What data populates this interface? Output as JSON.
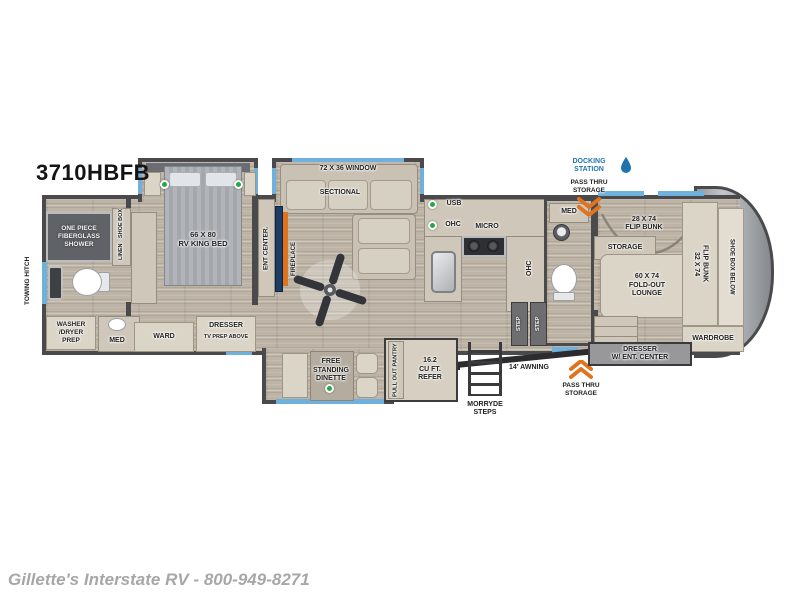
{
  "header": {
    "model": "3710HBFB"
  },
  "footer": {
    "dealer": "Gillette's Interstate RV - 800-949-8271"
  },
  "exterior": {
    "towing_hitch": "TOWING HITCH",
    "docking_station": "DOCKING\nSTATION",
    "pass_thru_top": "PASS THRU\nSTORAGE",
    "pass_thru_bottom": "PASS THRU\nSTORAGE",
    "awning": "14' AWNING",
    "steps": "MORRYDE\nSTEPS"
  },
  "front_bath": {
    "shower": "ONE PIECE\nFIBERGLASS\nSHOWER",
    "shoe_box": "SHOE BOX",
    "linen": "LINEN",
    "washer_dryer": "WASHER\n/DRYER\nPREP",
    "med": "MED"
  },
  "bedroom": {
    "king_bed": "66 X 80\nRV KING BED",
    "ward": "WARD",
    "dresser": "DRESSER",
    "tv_prep": "TV PREP ABOVE",
    "ent_center": "ENT CENTER.",
    "fireplace": "FIREPLACE"
  },
  "living": {
    "window": "72 X 36 WINDOW",
    "sectional": "SECTIONAL",
    "usb": "USB",
    "dinette": "FREE\nSTANDING\nDINETTE"
  },
  "kitchen": {
    "ohc": "OHC",
    "micro": "MICRO",
    "ohc_island": "OHC",
    "pantry": "PULL OUT PANTRY",
    "refer": "16.2\nCU FT.\nREFER"
  },
  "half_bath": {
    "med": "MED",
    "step_a": "STEP",
    "step_b": "STEP"
  },
  "bunk_room": {
    "flip_bunk_a": "28 X 74\nFLIP BUNK",
    "storage": "STORAGE",
    "lounge": "60 X 74\nFOLD-OUT\nLOUNGE",
    "flip_bunk_b": "32 X 74\nFLIP BUNK",
    "shoe_box": "SHOE BOX BELOW",
    "wardrobe": "WARDROBE",
    "dresser_ent": "DRESSER\nW/ ENT. CENTER"
  },
  "colors": {
    "wall": "#4a4a4c",
    "window_accent": "#6fb0dd",
    "led_green": "#27a844",
    "accent_orange": "#e0731d",
    "docking_blue": "#1f74ad"
  }
}
